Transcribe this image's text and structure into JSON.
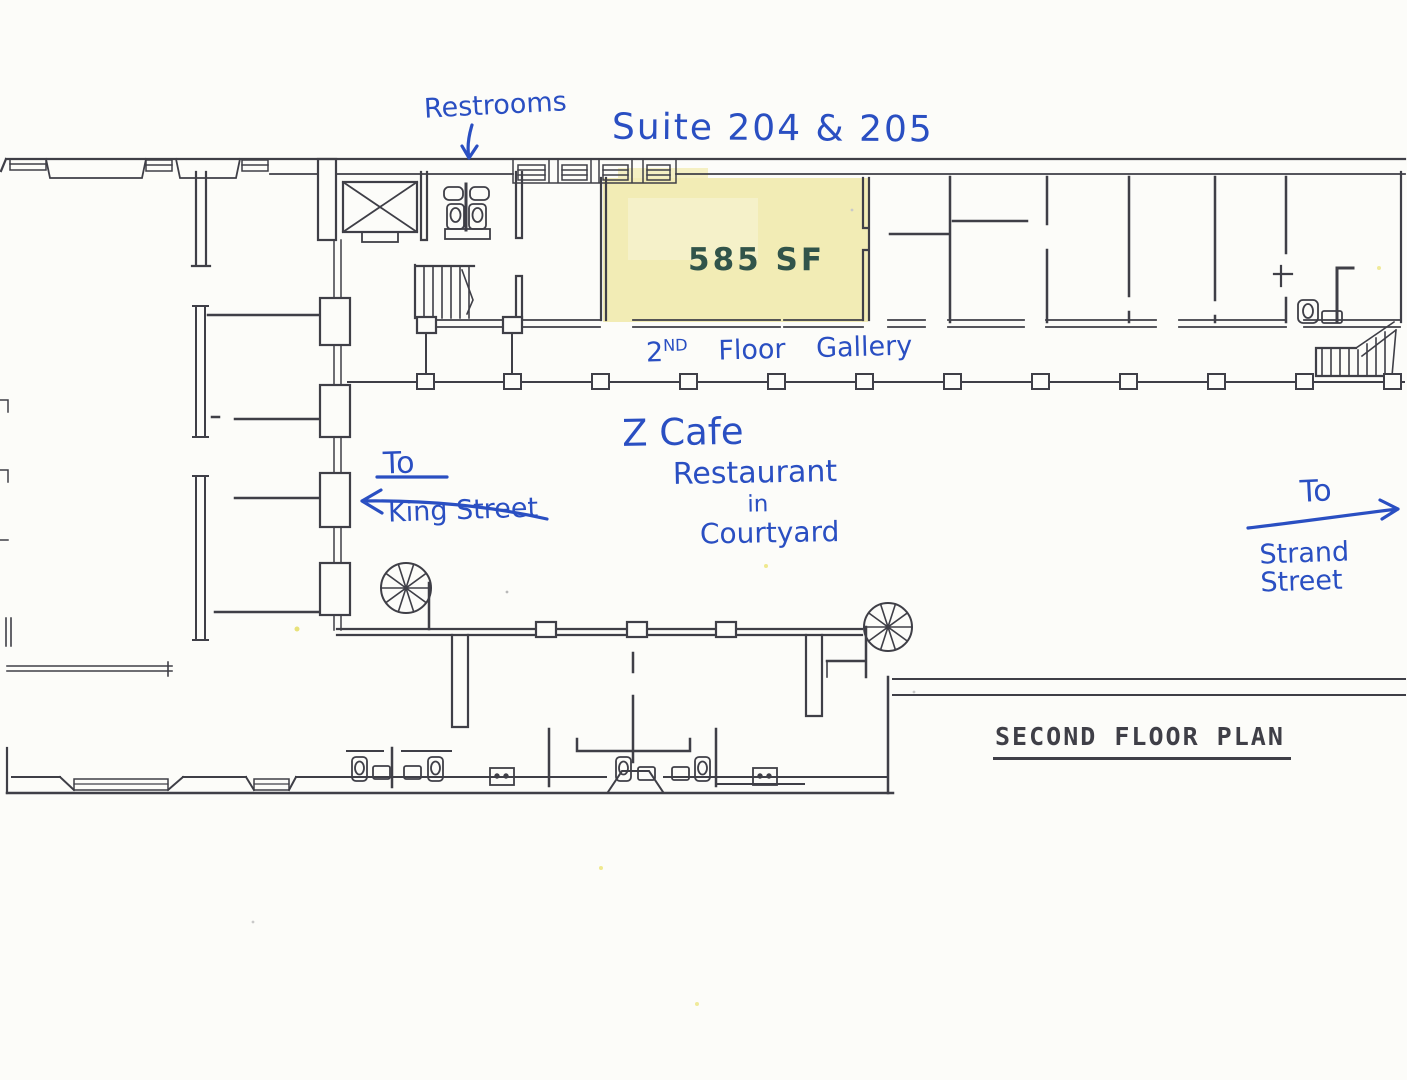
{
  "paper": {
    "background": "#fcfcf9"
  },
  "colors": {
    "plan_line": "#3f3f47",
    "blue_ink": "#2a4fc2",
    "marker_ink": "#31544a",
    "suite_highlight": "#f2ecb5"
  },
  "annotations": {
    "restrooms": {
      "text": "Restrooms"
    },
    "suite": {
      "text": "Suite 204 & 205"
    },
    "area": {
      "text": "585 SF"
    },
    "gallery": {
      "prefix": "2",
      "ordinal": "ND",
      "rest": "Floor Gallery"
    },
    "cafe": {
      "line1": "Z Cafe",
      "line2": "Restaurant",
      "line3": "in",
      "line4": "Courtyard"
    },
    "king": {
      "to": "To",
      "street": "King Street"
    },
    "strand": {
      "to": "To",
      "street_line1": "Strand",
      "street_line2": "Street"
    }
  },
  "title_block": {
    "text": "SECOND FLOOR PLAN"
  }
}
